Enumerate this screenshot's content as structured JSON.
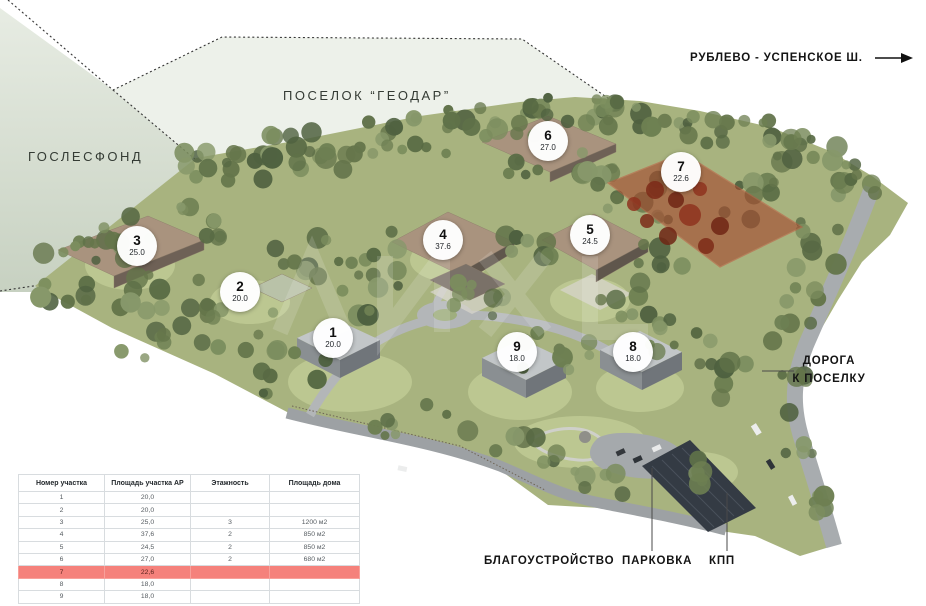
{
  "map": {
    "zone_labels": {
      "goslesfond": "ГОСЛЕСФОНД",
      "settlement": "ПОСЕЛОК “ГЕОДАР”",
      "highway": "РУБЛЕВО - УСПЕНСКОЕ Ш.",
      "road_line1": "ДОРОГА",
      "road_line2": "К ПОСЕЛКУ",
      "landscaping": "БЛАГОУСТРОЙСТВО",
      "parking": "ПАРКОВКА",
      "checkpoint": "КПП"
    },
    "icons": {
      "highway_direction": "arrow-right-icon"
    },
    "highlighted_plot": "7",
    "highlight_color": "#a63c25",
    "markers": [
      {
        "number": "1",
        "area": "20.0",
        "x": 333,
        "y": 338,
        "highlighted": false
      },
      {
        "number": "2",
        "area": "20.0",
        "x": 240,
        "y": 292,
        "highlighted": false
      },
      {
        "number": "3",
        "area": "25.0",
        "x": 137,
        "y": 246,
        "highlighted": false
      },
      {
        "number": "4",
        "area": "37.6",
        "x": 443,
        "y": 240,
        "highlighted": false
      },
      {
        "number": "5",
        "area": "24.5",
        "x": 590,
        "y": 235,
        "highlighted": false
      },
      {
        "number": "6",
        "area": "27.0",
        "x": 548,
        "y": 141,
        "highlighted": false
      },
      {
        "number": "7",
        "area": "22.6",
        "x": 681,
        "y": 172,
        "highlighted": true
      },
      {
        "number": "8",
        "area": "18.0",
        "x": 633,
        "y": 352,
        "highlighted": false
      },
      {
        "number": "9",
        "area": "18.0",
        "x": 517,
        "y": 352,
        "highlighted": false
      }
    ]
  },
  "table": {
    "headers": [
      "Номер участка",
      "Площадь участка АР",
      "Этажность",
      "Площадь дома"
    ],
    "rows": [
      [
        "1",
        "20,0",
        "",
        ""
      ],
      [
        "2",
        "20,0",
        "",
        ""
      ],
      [
        "3",
        "25,0",
        "3",
        "1200 м2"
      ],
      [
        "4",
        "37,6",
        "2",
        "850 м2"
      ],
      [
        "5",
        "24,5",
        "2",
        "850 м2"
      ],
      [
        "6",
        "27,0",
        "2",
        "680 м2"
      ],
      [
        "7",
        "22,6",
        "",
        ""
      ],
      [
        "8",
        "18,0",
        "",
        ""
      ],
      [
        "9",
        "18,0",
        "",
        ""
      ]
    ],
    "highlighted_row_index": 6,
    "highlight_color": "#f5817b"
  }
}
